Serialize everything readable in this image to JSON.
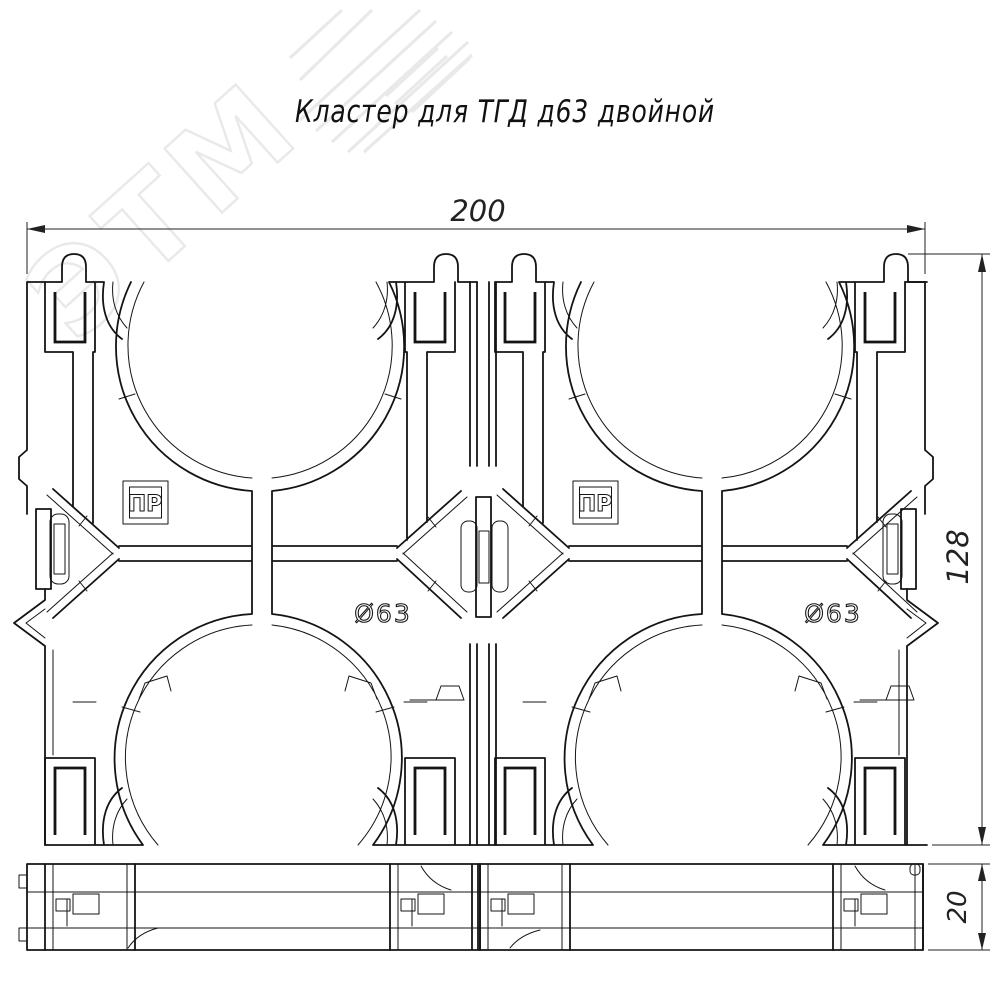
{
  "title": "Кластер для ТГД д63 двойной",
  "watermark": {
    "text": "ЭТМ"
  },
  "dimensions": {
    "width": "200",
    "height": "128",
    "thickness": "20"
  },
  "labels": {
    "stamp": "ПР",
    "diameter": "Ø63"
  },
  "colors": {
    "line": "#141414",
    "dim": "#222222",
    "background": "#ffffff",
    "watermark": "#e9e9e9"
  }
}
